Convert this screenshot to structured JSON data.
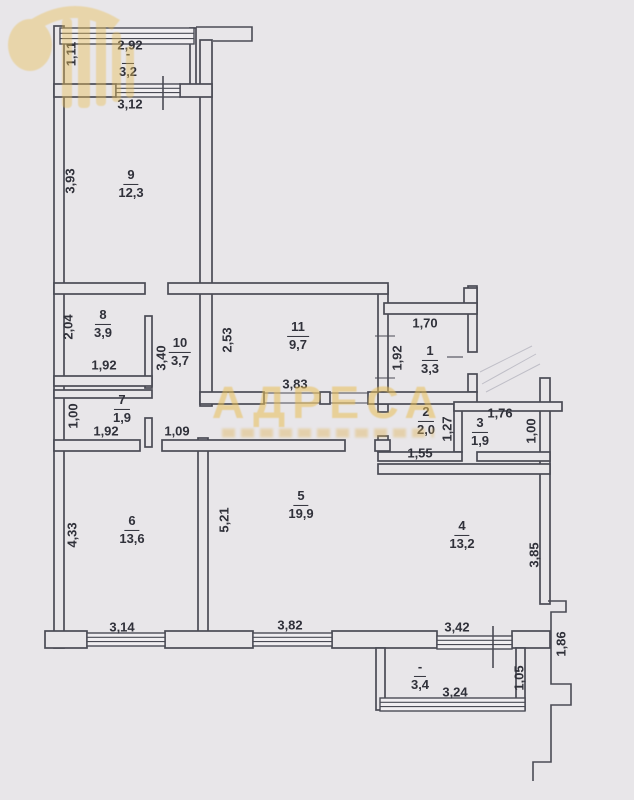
{
  "plan": {
    "type": "apartment floor plan (BTI scan)",
    "watermark": {
      "title": "АДРЕСА"
    },
    "colors": {
      "background": "#e8e6e9",
      "wall": "#4a4b55",
      "text": "#30313a",
      "watermark": "#e8be55"
    },
    "rooms": [
      {
        "key": "balcony-top",
        "number": "-",
        "area": "3,2"
      },
      {
        "key": "room-9",
        "number": "9",
        "area": "12,3"
      },
      {
        "key": "room-8",
        "number": "8",
        "area": "3,9"
      },
      {
        "key": "room-10",
        "number": "10",
        "area": "3,7"
      },
      {
        "key": "room-7",
        "number": "7",
        "area": "1,9"
      },
      {
        "key": "room-11",
        "number": "11",
        "area": "9,7"
      },
      {
        "key": "room-1",
        "number": "1",
        "area": "3,3"
      },
      {
        "key": "room-2",
        "number": "2",
        "area": "2,0"
      },
      {
        "key": "room-3",
        "number": "3",
        "area": "1,9"
      },
      {
        "key": "room-6",
        "number": "6",
        "area": "13,6"
      },
      {
        "key": "room-5",
        "number": "5",
        "area": "19,9"
      },
      {
        "key": "room-4",
        "number": "4",
        "area": "13,2"
      },
      {
        "key": "balcony-bottom",
        "number": "-",
        "area": "3,4"
      }
    ],
    "dimensions": [
      {
        "key": "dim-balcony-top-width",
        "text": "2,92"
      },
      {
        "key": "dim-balcony-top-depth",
        "text": "1,11"
      },
      {
        "key": "dim-room9-width",
        "text": "3,12"
      },
      {
        "key": "dim-room9-height",
        "text": "3,93"
      },
      {
        "key": "dim-room8-height",
        "text": "2,04"
      },
      {
        "key": "dim-room8-width",
        "text": "1,92"
      },
      {
        "key": "dim-room10-height",
        "text": "3,40"
      },
      {
        "key": "dim-room7-height",
        "text": "1,00"
      },
      {
        "key": "dim-room7-width",
        "text": "1,92"
      },
      {
        "key": "dim-corridor-width",
        "text": "1,09"
      },
      {
        "key": "dim-room11-height",
        "text": "2,53"
      },
      {
        "key": "dim-room11-width",
        "text": "3,83"
      },
      {
        "key": "dim-room1-width",
        "text": "1,70"
      },
      {
        "key": "dim-room1-height",
        "text": "1,92"
      },
      {
        "key": "dim-room2-width",
        "text": "1,55"
      },
      {
        "key": "dim-room2-height",
        "text": "1,27"
      },
      {
        "key": "dim-room3-width",
        "text": "1,76"
      },
      {
        "key": "dim-room3-height",
        "text": "1,00"
      },
      {
        "key": "dim-room6-height",
        "text": "4,33"
      },
      {
        "key": "dim-room6-width",
        "text": "3,14"
      },
      {
        "key": "dim-room5-height",
        "text": "5,21"
      },
      {
        "key": "dim-room5-width",
        "text": "3,82"
      },
      {
        "key": "dim-room4-height",
        "text": "3,85"
      },
      {
        "key": "dim-room4-width",
        "text": "3,42"
      },
      {
        "key": "dim-right-wing",
        "text": "1,86"
      },
      {
        "key": "dim-balcony-bottom-height",
        "text": "1,05"
      },
      {
        "key": "dim-balcony-bottom-width",
        "text": "3,24"
      }
    ]
  }
}
